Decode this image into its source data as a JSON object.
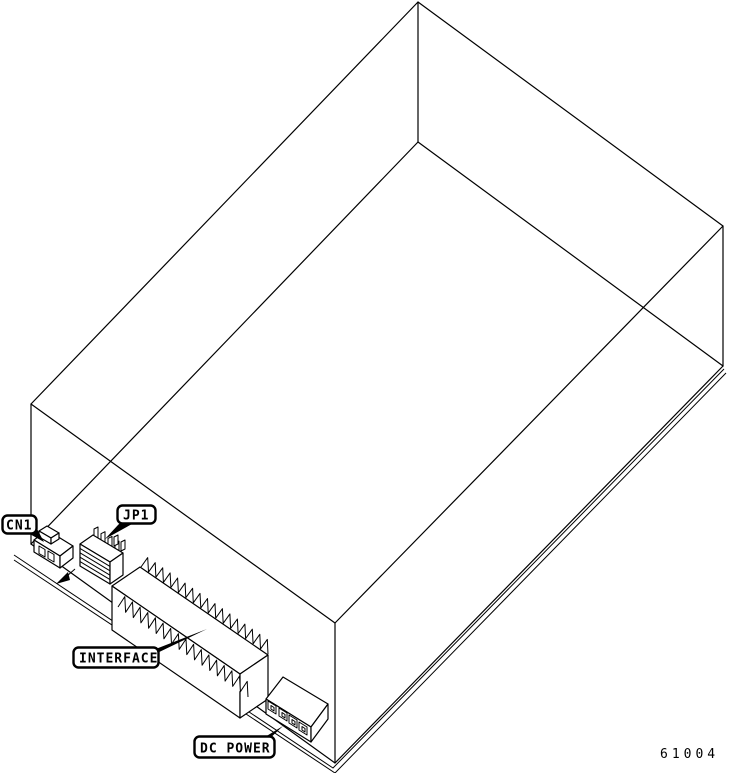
{
  "figure": {
    "description": "Isometric wireframe line drawing of a disk drive enclosure showing rear edge-board connectors",
    "number": "61004",
    "colors": {
      "line": "#000000",
      "background": "#ffffff"
    },
    "callouts": {
      "cn1": "CN1",
      "jp1": "JP1",
      "interface": "INTERFACE",
      "dc_power": "DC POWER"
    }
  }
}
